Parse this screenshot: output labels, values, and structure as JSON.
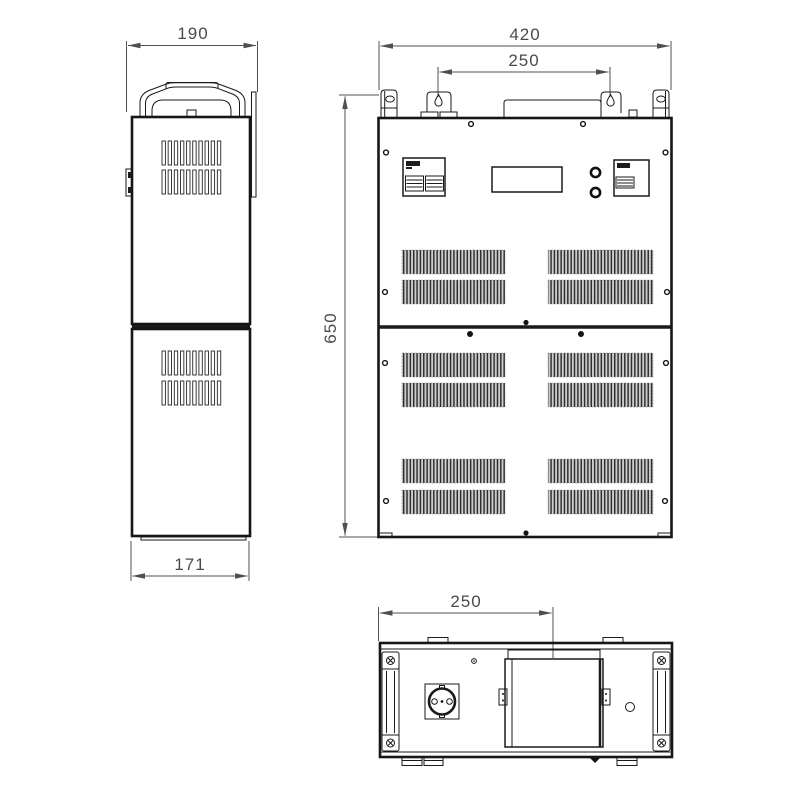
{
  "dimensions": {
    "side_top_width": "190",
    "side_bottom_width": "171",
    "front_width": "420",
    "front_mount_spacing": "250",
    "front_height": "650",
    "bottom_cover_offset": "250"
  },
  "colors": {
    "background": "#ffffff",
    "outline": "#1a1a1a",
    "dimension": "#505050",
    "vent_shade": "#cdcdcd"
  }
}
